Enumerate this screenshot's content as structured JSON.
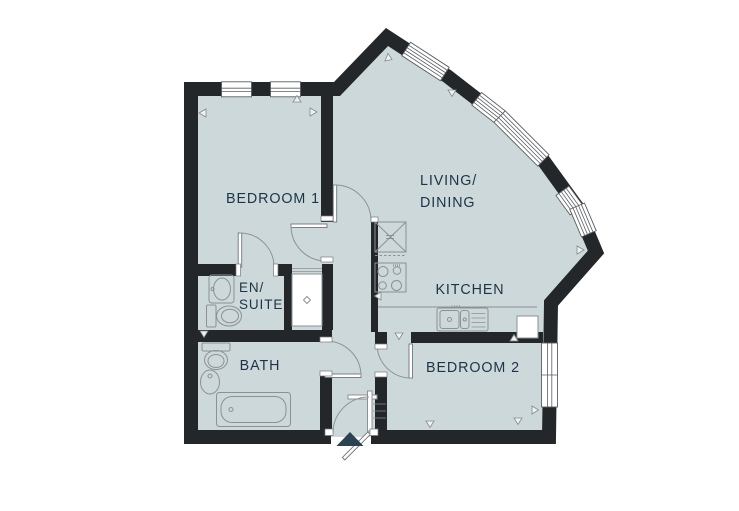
{
  "floorplan": {
    "labels": {
      "bedroom1": "BEDROOM 1",
      "living_line1": "LIVING/",
      "living_line2": "DINING",
      "kitchen": "KITCHEN",
      "ensuite_line1": "EN/",
      "ensuite_line2": "SUITE",
      "bath": "BATH",
      "bedroom2": "BEDROOM 2"
    },
    "colors": {
      "wall": "#23272a",
      "floor": "#ccd8da",
      "label_text": "#1d3447",
      "entrance_marker": "#2c4250",
      "fixture_outline": "#8d9194",
      "background": "#ffffff"
    },
    "fixtures": [
      "window",
      "door-swing",
      "entrance-arrow",
      "toilet",
      "basin",
      "bathtub",
      "sink-with-drainer",
      "hob",
      "tall-kitchen-unit",
      "storage-cupboard",
      "wardrobe-cupboard"
    ]
  }
}
